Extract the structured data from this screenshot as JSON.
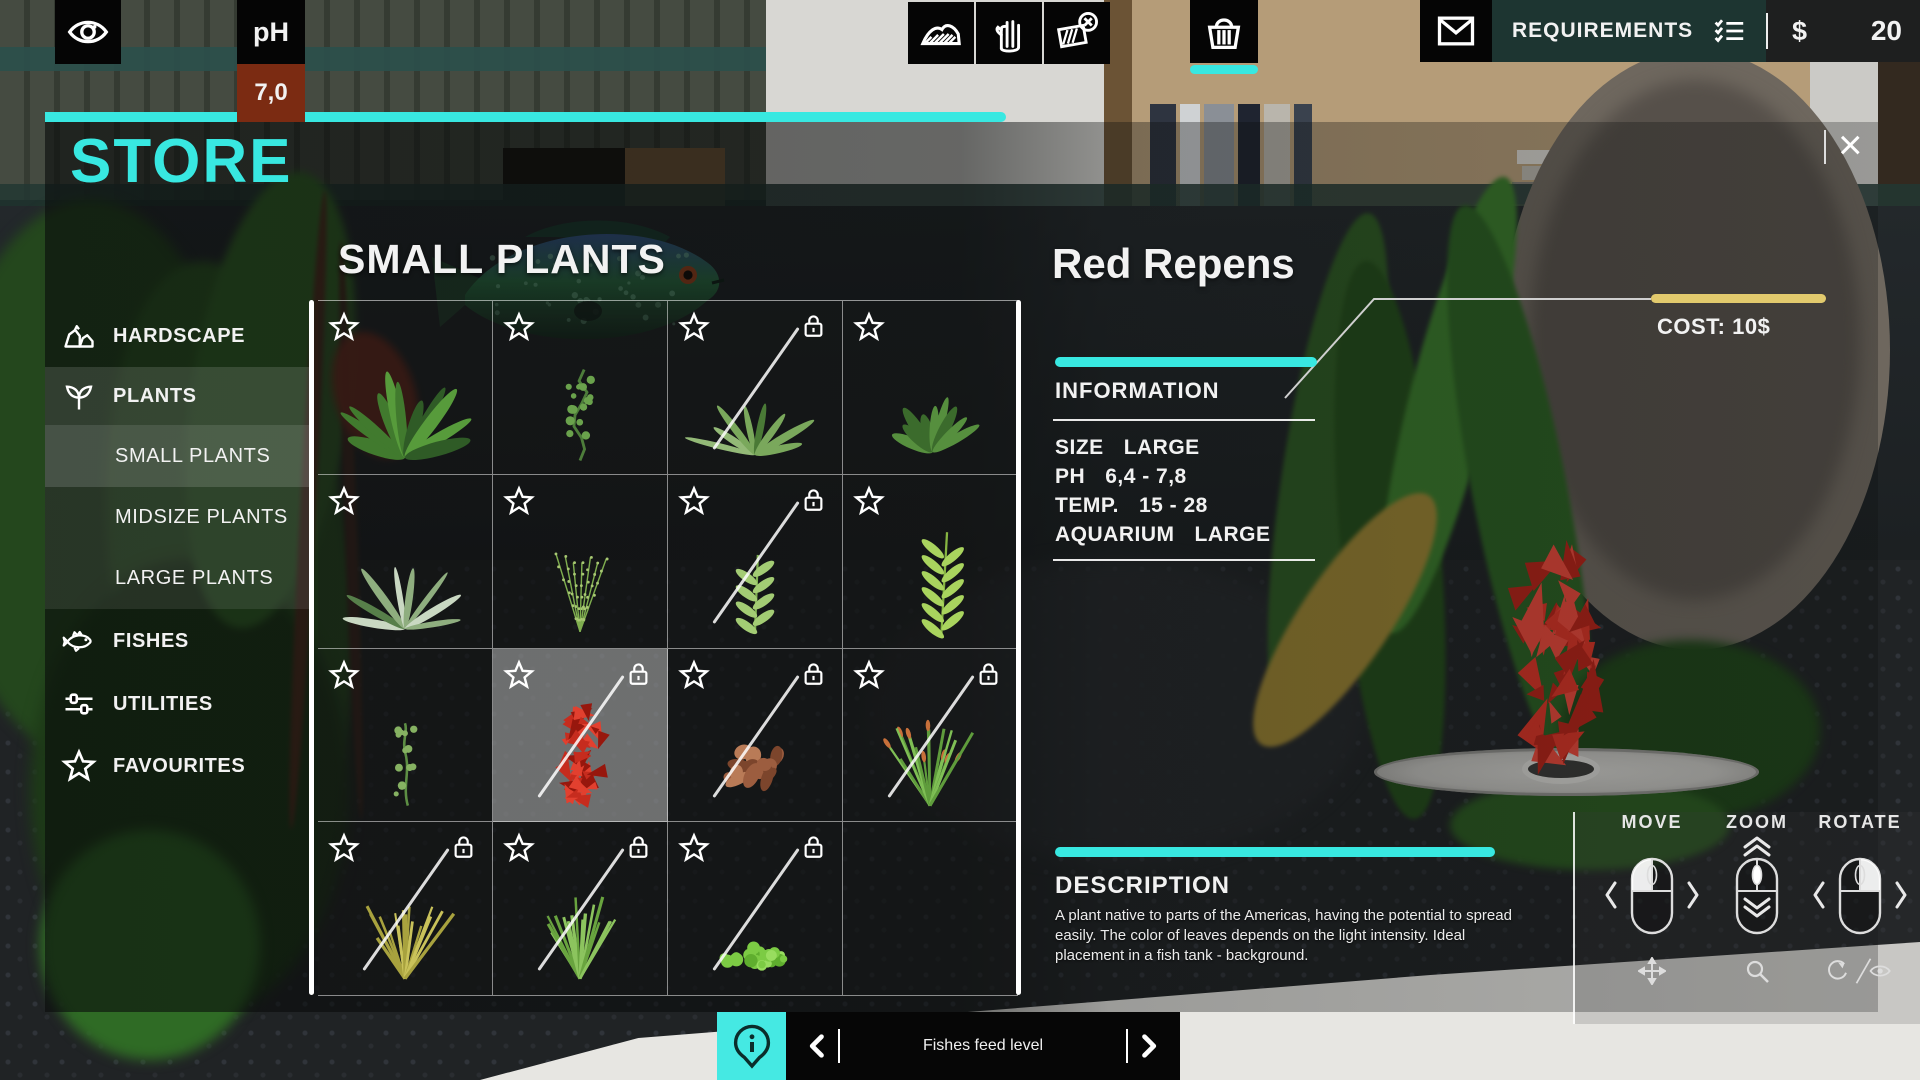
{
  "topbar": {
    "eye_icon": "eye-icon",
    "ph_label": "pH",
    "ph_value": "7,0",
    "tools": [
      {
        "icon": "substrate-icon"
      },
      {
        "icon": "hand-icon"
      },
      {
        "icon": "eraser-icon"
      }
    ],
    "basket_icon": "basket-icon",
    "mail_icon": "envelope-icon",
    "requirements_label": "REQUIREMENTS",
    "checklist_icon": "checklist-icon",
    "currency_symbol": "$",
    "money": "20"
  },
  "store": {
    "title": "STORE",
    "close_label": "×",
    "grid_title": "SMALL PLANTS",
    "sidebar": [
      {
        "label": "HARDSCAPE",
        "icon": "rocks-icon",
        "sub": false,
        "selected": false
      },
      {
        "label": "PLANTS",
        "icon": "sprout-icon",
        "sub": false,
        "selected": false,
        "active": true
      },
      {
        "label": "SMALL PLANTS",
        "icon": "",
        "sub": true,
        "selected": true
      },
      {
        "label": "MIDSIZE PLANTS",
        "icon": "",
        "sub": true,
        "selected": false
      },
      {
        "label": "LARGE PLANTS",
        "icon": "",
        "sub": true,
        "selected": false
      },
      {
        "label": "FISHES",
        "icon": "fish-icon",
        "sub": false,
        "selected": false
      },
      {
        "label": "UTILITIES",
        "icon": "sliders-icon",
        "sub": false,
        "selected": false
      },
      {
        "label": "FAVOURITES",
        "icon": "star-icon",
        "sub": false,
        "selected": false
      }
    ],
    "cells": [
      {
        "plant": "bushy",
        "star": true,
        "lock": false,
        "slash": false,
        "sel": false,
        "palette": [
          "#2f5b26",
          "#417a2e",
          "#579b3b"
        ]
      },
      {
        "plant": "vine",
        "star": true,
        "lock": false,
        "slash": false,
        "sel": false,
        "palette": [
          "#4d7d3a",
          "#6aa24c"
        ]
      },
      {
        "plant": "rosette",
        "star": true,
        "lock": true,
        "slash": true,
        "sel": false,
        "palette": [
          "#4a7a36",
          "#7aa85c",
          "#93b977"
        ]
      },
      {
        "plant": "bushy_sm",
        "star": true,
        "lock": false,
        "slash": false,
        "sel": false,
        "palette": [
          "#3b6b2c",
          "#568f3e"
        ]
      },
      {
        "plant": "rosette",
        "star": true,
        "lock": false,
        "slash": false,
        "sel": false,
        "palette": [
          "#577f4a",
          "#8fae7f",
          "#c9d8c2"
        ]
      },
      {
        "plant": "sparse",
        "star": true,
        "lock": false,
        "slash": false,
        "sel": false,
        "palette": [
          "#7fae4f",
          "#a8c873"
        ]
      },
      {
        "plant": "stem",
        "star": true,
        "lock": true,
        "slash": true,
        "sel": false,
        "palette": [
          "#7fb052",
          "#a3cc74"
        ]
      },
      {
        "plant": "stem_tall",
        "star": true,
        "lock": false,
        "slash": false,
        "sel": false,
        "palette": [
          "#86b542",
          "#a9d45e"
        ]
      },
      {
        "plant": "vine_sm",
        "star": true,
        "lock": false,
        "slash": false,
        "sel": false,
        "palette": [
          "#5d8f44",
          "#86b262"
        ]
      },
      {
        "plant": "red",
        "star": true,
        "lock": true,
        "slash": true,
        "sel": true,
        "palette": [
          "#c62c1e",
          "#e2402f",
          "#97170d"
        ]
      },
      {
        "plant": "copper",
        "star": true,
        "lock": true,
        "slash": true,
        "sel": false,
        "palette": [
          "#9c5d3f",
          "#b97b57",
          "#7c452c"
        ]
      },
      {
        "plant": "grass_orange",
        "star": true,
        "lock": true,
        "slash": true,
        "sel": false,
        "palette": [
          "#5f9c3c",
          "#7fbf55",
          "#c8703a"
        ]
      },
      {
        "plant": "grass",
        "star": true,
        "lock": true,
        "slash": true,
        "sel": false,
        "palette": [
          "#c9c25a",
          "#a8a23e",
          "#8f8a33"
        ]
      },
      {
        "plant": "grass",
        "star": true,
        "lock": true,
        "slash": true,
        "sel": false,
        "palette": [
          "#69a43f",
          "#8cc45e",
          "#b7d77f"
        ]
      },
      {
        "plant": "cover",
        "star": true,
        "lock": true,
        "slash": true,
        "sel": false,
        "palette": [
          "#5fae2e",
          "#7ccb44",
          "#98dd5f"
        ]
      },
      {
        "plant": "none",
        "star": false,
        "lock": false,
        "slash": false,
        "sel": false,
        "palette": []
      }
    ]
  },
  "detail": {
    "name": "Red Repens",
    "cost_label": "COST: 10$",
    "cost_bar_color": "#e2ca6d",
    "accent_color": "#38e8e1",
    "information": {
      "title": "INFORMATION",
      "rows": [
        {
          "label": "SIZE",
          "value": "LARGE"
        },
        {
          "label": "PH",
          "value": "6,4 - 7,8"
        },
        {
          "label": "TEMP.",
          "value": "15 - 28"
        },
        {
          "label": "AQUARIUM",
          "value": "LARGE"
        }
      ]
    },
    "description": {
      "title": "DESCRIPTION",
      "text": "A plant native to parts of the Americas, having the potential to spread easily. The color of leaves depends on the light intensity. Ideal placement in a fish tank - background."
    }
  },
  "controls": {
    "items": [
      {
        "label": "MOVE",
        "highlight": "left",
        "icon": "move-cross-icon"
      },
      {
        "label": "ZOOM",
        "highlight": "wheel",
        "icon": "magnifier-icon"
      },
      {
        "label": "ROTATE",
        "highlight": "right",
        "icon": "rotate-eye-icon"
      }
    ]
  },
  "bottom_bar": {
    "info_icon": "info-pin-icon",
    "prev_icon": "chevron-left-icon",
    "next_icon": "chevron-right-icon",
    "label": "Fishes feed level"
  }
}
